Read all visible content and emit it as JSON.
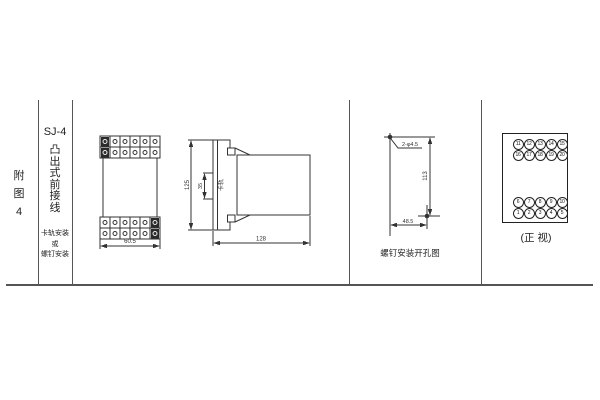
{
  "page": {
    "background": "#ffffff",
    "line_color": "#333333"
  },
  "row_label": {
    "text": "附\n图\n4"
  },
  "spec_column": {
    "model": "SJ-4",
    "case_type": "凸\n出\n式\n前\n接\n线",
    "mounting": "卡轨安装\n或\n螺钉安装"
  },
  "front_view": {
    "width_dim": "60.5"
  },
  "side_view": {
    "height_dim": "125",
    "rail_width_dim": "35",
    "rail_label": "卡轨",
    "depth_dim": "128"
  },
  "drill_view": {
    "holes_spec": "2-φ4.5",
    "hole_v_spacing": "113",
    "hole_h_spacing": "48.5",
    "caption": "螺钉安装开孔图"
  },
  "terminal_view": {
    "caption": "(正 视)",
    "rows": [
      [
        "11",
        "12",
        "13",
        "14",
        "15"
      ],
      [
        "16",
        "17",
        "18",
        "19",
        "20"
      ],
      [
        "6",
        "7",
        "8",
        "9",
        "10"
      ],
      [
        "1",
        "2",
        "3",
        "4",
        "5"
      ]
    ]
  }
}
